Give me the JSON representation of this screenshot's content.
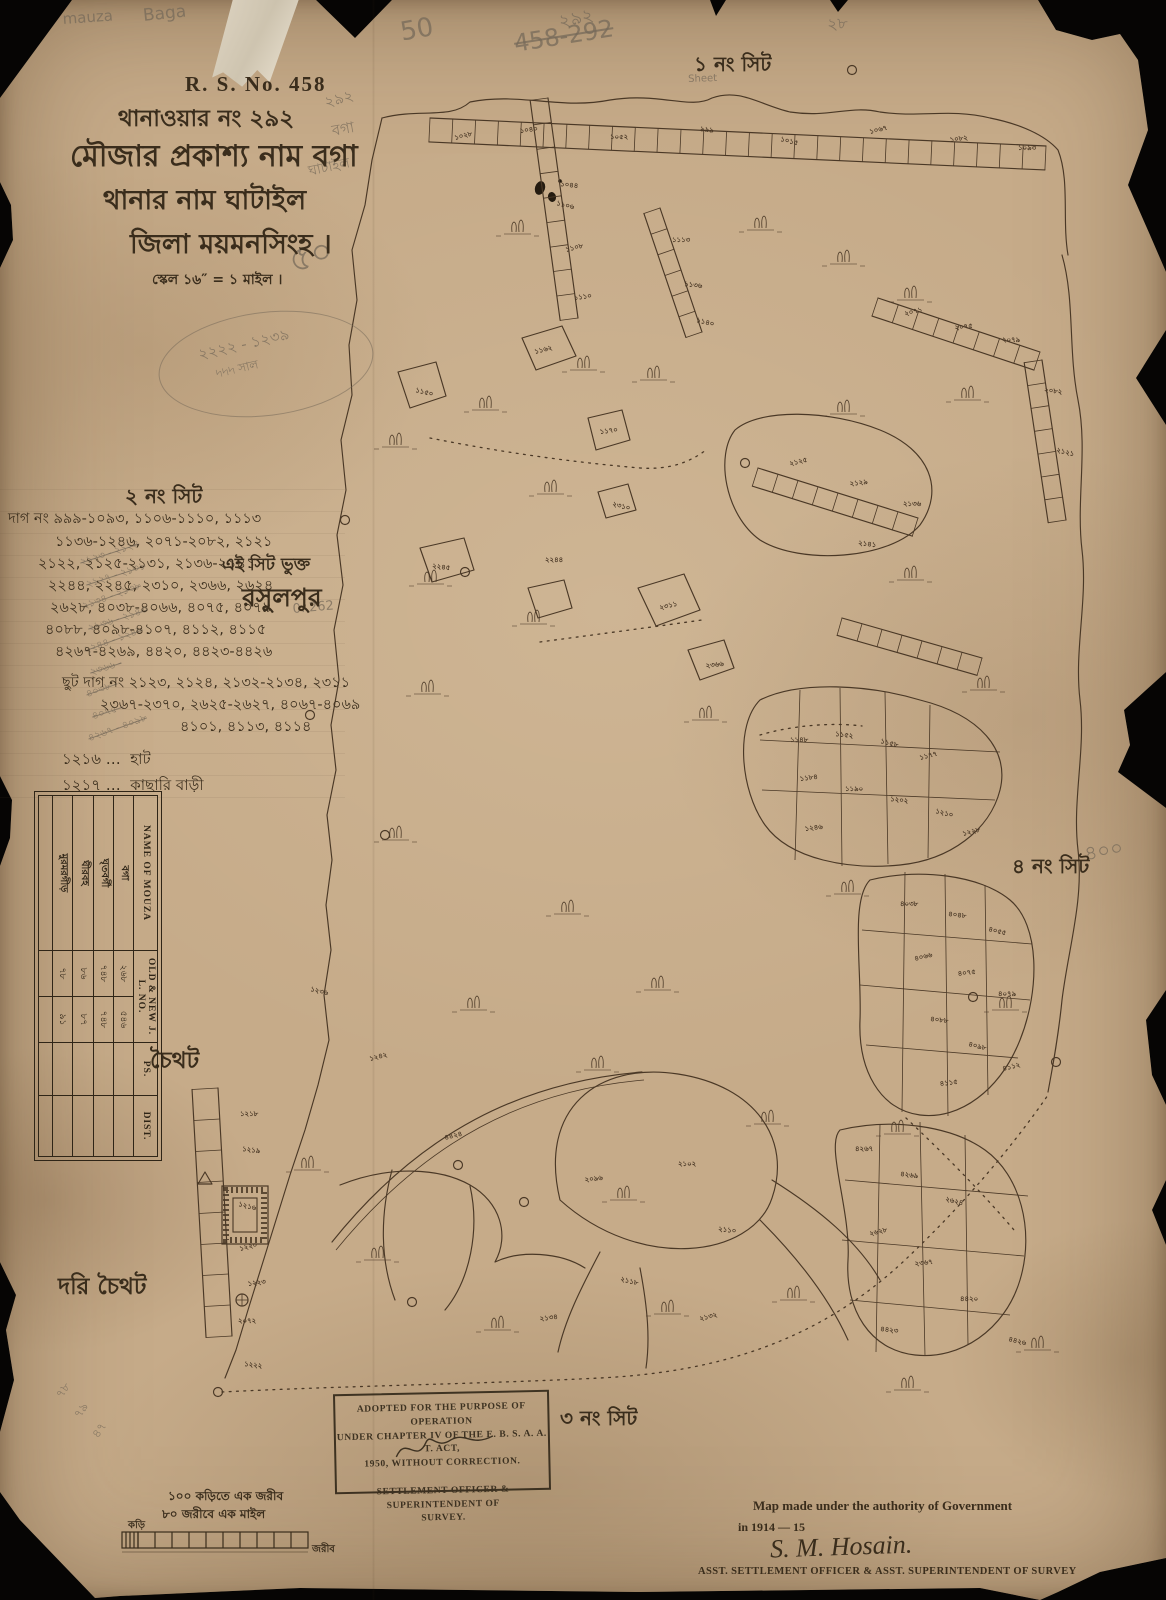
{
  "colors": {
    "paper": "#c6ab89",
    "ink": "#3a2d1c",
    "map_ink": "#4a3826",
    "pencil": "#766a5a",
    "backing": "#060504",
    "tape": "#d8cfbd"
  },
  "header": {
    "rs_no": "R. S. No. 458",
    "line_thana_no": "থানাওয়ার নং ২৯২",
    "line_mouza": "মৌজার প্রকাশ্য নাম  বগা",
    "line_thana": "থানার নাম ঘাটাইল",
    "line_district": "জিলা ময়মনসিংহ ।",
    "line_scale": "স্কেল ১৬″ = ১ মাইল ।"
  },
  "sheets": {
    "s1": "১ নং সিট",
    "s2": "২ নং সিট",
    "s3": "৩ নং সিট",
    "s4": "৪ নং সিট"
  },
  "dag": {
    "lines": [
      "দাগ নং ৯৯৯-১০৯৩, ১১০৬-১১১০, ১১১৩",
      "১১৩৬-১২৪৬, ২০৭১-২০৮২, ২১২১",
      "২১২২, ২১২৫-২১৩১, ২১৩৬-২১৪১",
      "২২৪৪, ২২৪৫, ২৩১০, ২৩৬৬, ২৬২৪",
      "২৬২৮, ৪০৩৮-৪০৬৬, ৪০৭৫, ৪০৭৯",
      "৪০৮৮, ৪০৯৮-৪১০৭, ৪১১২, ৪১১৫",
      "৪২৬৭-৪২৬৯, ৪৪২০, ৪৪২৩-৪৪২৬"
    ],
    "side_note": "এই সিট ভুক্ত",
    "village": "রসুলপুর",
    "chhut": [
      "ছুট দাগ নং ২১২৩, ২১২৪, ২১৩২-২১৩৪, ২৩১১",
      "২৩৬৭-২৩৭০, ২৬২৫-২৬২৭, ৪০৬৭-৪০৬৯",
      "৪১০১, ৪১১৩, ৪১১৪"
    ],
    "legend": [
      {
        "no": "১২১৬ …",
        "label": "হাট"
      },
      {
        "no": "১২১৭ …",
        "label": "কাছারি বাড়ী"
      }
    ]
  },
  "places": {
    "choithot": "চৈথট",
    "dori_choithot": "দরি চৈথট"
  },
  "table": {
    "h_name": "NAME OF MOUZA",
    "h_jl": "OLD & NEW J. L. NO.",
    "h_ps": "PS.",
    "h_dist": "DIST.",
    "rows": [
      {
        "name": "বগা",
        "old": "২৬৮",
        "new": "৫৪৬",
        "ps": "",
        "dist": ""
      },
      {
        "name": "ঘৃতবর্গী",
        "old": "৭৪৮",
        "new": "৭৪৮",
        "ps": "",
        "dist": ""
      },
      {
        "name": "ঘীরবহ",
        "old": "৮৬",
        "new": "৮৭",
        "ps": "",
        "dist": ""
      },
      {
        "name": "মুরমরগীড়",
        "old": "৭৮",
        "new": "৯১",
        "ps": "",
        "dist": ""
      }
    ]
  },
  "stamp": {
    "l1": "ADOPTED FOR THE PURPOSE OF OPERATION",
    "l2": "UNDER CHAPTER IV OF THE E. B. S. A. A. T. ACT,",
    "l3": "1950, WITHOUT CORRECTION.",
    "l4": "SETTLEMENT OFFICER & SUPERINTENDENT OF",
    "l5": "SURVEY."
  },
  "attribution": {
    "l1": "Map made under the authority of Government",
    "l2": "in 1914 — 15",
    "sig": "S. M. Hosain.",
    "l3": "ASST. SETTLEMENT OFFICER & ASST. SUPERINTENDENT OF SURVEY"
  },
  "scalebar": {
    "l1": "১০০ কড়িতে এক জরীব",
    "l2": "৮০ জরীবে এক মাইল",
    "left": "কড়ি",
    "right": "জরীব"
  },
  "pencil": {
    "scribbles": [
      {
        "x": 62,
        "y": 10,
        "t": "mauza",
        "r": -4,
        "s": 15
      },
      {
        "x": 142,
        "y": 6,
        "t": "Baga",
        "r": -6,
        "s": 17
      },
      {
        "x": 556,
        "y": 8,
        "t": "২৯২",
        "r": -12,
        "s": 18
      },
      {
        "x": 512,
        "y": 30,
        "t": "458-292",
        "r": -9,
        "s": 24,
        "strike": true
      },
      {
        "x": 398,
        "y": 18,
        "t": "50",
        "r": -10,
        "s": 26
      },
      {
        "x": 826,
        "y": 12,
        "t": "২৮",
        "r": -5,
        "s": 16
      },
      {
        "x": 322,
        "y": 92,
        "t": "২৯২",
        "r": -15,
        "s": 15
      },
      {
        "x": 330,
        "y": 120,
        "t": "বগা",
        "r": -10,
        "s": 15
      },
      {
        "x": 306,
        "y": 160,
        "t": "ঘাটাইল",
        "r": -12,
        "s": 14
      },
      {
        "x": 282,
        "y": 238,
        "t": "৫০",
        "r": -18,
        "s": 34
      },
      {
        "x": 196,
        "y": 344,
        "t": "২২২২ - ১২৩৯",
        "r": -13,
        "s": 15
      },
      {
        "x": 214,
        "y": 366,
        "t": "৸৸৸ সাল",
        "r": -13,
        "s": 12
      },
      {
        "x": 688,
        "y": 74,
        "t": "Sheet",
        "r": -2,
        "s": 10
      },
      {
        "x": 292,
        "y": 602,
        "t": "0. 262",
        "r": -5,
        "s": 13
      },
      {
        "x": 1082,
        "y": 840,
        "t": "৪০০",
        "r": -10,
        "s": 20
      },
      {
        "x": 78,
        "y": 556,
        "t": "২১২৩ - ২১২৪",
        "r": -18,
        "s": 10,
        "strike": true
      },
      {
        "x": 84,
        "y": 578,
        "t": "২১২৭ - ২১৩১",
        "r": -18,
        "s": 10,
        "strike": true
      },
      {
        "x": 80,
        "y": 600,
        "t": "২১৩৪ - ২১৩৮",
        "r": -20,
        "s": 10,
        "strike": true
      },
      {
        "x": 86,
        "y": 622,
        "t": "২১৩৬ - ২১৪৩",
        "r": -18,
        "s": 10,
        "strike": true
      },
      {
        "x": 82,
        "y": 644,
        "t": "২২৪৪ - ১২৪৮",
        "r": -20,
        "s": 10,
        "strike": true
      },
      {
        "x": 88,
        "y": 666,
        "t": "২৩৬৬ -",
        "r": -18,
        "s": 10,
        "strike": true
      },
      {
        "x": 84,
        "y": 688,
        "t": "৪০৩৮ -",
        "r": -20,
        "s": 10,
        "strike": true
      },
      {
        "x": 90,
        "y": 710,
        "t": "৪০৭৫ -",
        "r": -18,
        "s": 10,
        "strike": true
      },
      {
        "x": 86,
        "y": 732,
        "t": "৪২৬৭ - ৪০৯৮",
        "r": -20,
        "s": 10,
        "strike": true
      },
      {
        "x": 52,
        "y": 1392,
        "t": "৭৮",
        "r": -55,
        "s": 12
      },
      {
        "x": 70,
        "y": 1412,
        "t": "৭৯",
        "r": -55,
        "s": 12
      },
      {
        "x": 88,
        "y": 1432,
        "t": "৪৭",
        "r": -55,
        "s": 12
      }
    ]
  },
  "map": {
    "plot_labels": [
      {
        "x": 455,
        "y": 140,
        "t": "১০২৮"
      },
      {
        "x": 520,
        "y": 133,
        "t": "১০৪০"
      },
      {
        "x": 610,
        "y": 139,
        "t": "১০৫২"
      },
      {
        "x": 700,
        "y": 131,
        "t": "৯৯৯"
      },
      {
        "x": 780,
        "y": 141,
        "t": "১০১৫"
      },
      {
        "x": 870,
        "y": 134,
        "t": "১০৬৭"
      },
      {
        "x": 950,
        "y": 142,
        "t": "১০৮২"
      },
      {
        "x": 1018,
        "y": 150,
        "t": "১০৯৩"
      },
      {
        "x": 560,
        "y": 186,
        "t": "১০৪৪"
      },
      {
        "x": 556,
        "y": 205,
        "t": "১১০৬"
      },
      {
        "x": 566,
        "y": 252,
        "t": "১১০৮"
      },
      {
        "x": 574,
        "y": 300,
        "t": "১১১০"
      },
      {
        "x": 672,
        "y": 242,
        "t": "১১১৩"
      },
      {
        "x": 684,
        "y": 286,
        "t": "১১৩৬"
      },
      {
        "x": 696,
        "y": 322,
        "t": "১১৪০"
      },
      {
        "x": 905,
        "y": 316,
        "t": "২০৭১"
      },
      {
        "x": 955,
        "y": 330,
        "t": "২০৭৫"
      },
      {
        "x": 1002,
        "y": 342,
        "t": "২০৭৯"
      },
      {
        "x": 1044,
        "y": 392,
        "t": "২০৮২"
      },
      {
        "x": 1056,
        "y": 452,
        "t": "২১২১"
      },
      {
        "x": 790,
        "y": 466,
        "t": "২১২৫"
      },
      {
        "x": 850,
        "y": 486,
        "t": "২১২৯"
      },
      {
        "x": 903,
        "y": 506,
        "t": "২১৩৬"
      },
      {
        "x": 858,
        "y": 545,
        "t": "২১৪১"
      },
      {
        "x": 415,
        "y": 392,
        "t": "১১৫০"
      },
      {
        "x": 535,
        "y": 354,
        "t": "১১৬২"
      },
      {
        "x": 600,
        "y": 434,
        "t": "১১৭০"
      },
      {
        "x": 545,
        "y": 562,
        "t": "২২৪৪"
      },
      {
        "x": 432,
        "y": 568,
        "t": "২২৪৫"
      },
      {
        "x": 612,
        "y": 506,
        "t": "২৩১০"
      },
      {
        "x": 660,
        "y": 610,
        "t": "২৩১১"
      },
      {
        "x": 706,
        "y": 668,
        "t": "২৩৬৬"
      },
      {
        "x": 790,
        "y": 742,
        "t": "১১৪৮"
      },
      {
        "x": 835,
        "y": 736,
        "t": "১১৫২"
      },
      {
        "x": 880,
        "y": 743,
        "t": "১১৫৮"
      },
      {
        "x": 920,
        "y": 760,
        "t": "১১৭৭"
      },
      {
        "x": 800,
        "y": 781,
        "t": "১১৮৪"
      },
      {
        "x": 845,
        "y": 791,
        "t": "১১৯০"
      },
      {
        "x": 890,
        "y": 801,
        "t": "১২০২"
      },
      {
        "x": 935,
        "y": 813,
        "t": "১২১০"
      },
      {
        "x": 963,
        "y": 836,
        "t": "১২২৮"
      },
      {
        "x": 805,
        "y": 831,
        "t": "১২৪৬"
      },
      {
        "x": 900,
        "y": 906,
        "t": "৪০৩৮"
      },
      {
        "x": 948,
        "y": 916,
        "t": "৪০৪৮"
      },
      {
        "x": 988,
        "y": 931,
        "t": "৪০৫৫"
      },
      {
        "x": 915,
        "y": 961,
        "t": "৪০৬৬"
      },
      {
        "x": 958,
        "y": 976,
        "t": "৪০৭৫"
      },
      {
        "x": 998,
        "y": 996,
        "t": "৪০৭৯"
      },
      {
        "x": 930,
        "y": 1021,
        "t": "৪০৮৮"
      },
      {
        "x": 968,
        "y": 1046,
        "t": "৪০৯৮"
      },
      {
        "x": 1003,
        "y": 1071,
        "t": "৪১১২"
      },
      {
        "x": 940,
        "y": 1086,
        "t": "৪১১৫"
      },
      {
        "x": 855,
        "y": 1151,
        "t": "৪২৬৭"
      },
      {
        "x": 900,
        "y": 1176,
        "t": "৪২৬৯"
      },
      {
        "x": 945,
        "y": 1201,
        "t": "২৬২৪"
      },
      {
        "x": 870,
        "y": 1236,
        "t": "২৬২৮"
      },
      {
        "x": 915,
        "y": 1266,
        "t": "২৩৬৭"
      },
      {
        "x": 960,
        "y": 1301,
        "t": "৪৪২০"
      },
      {
        "x": 880,
        "y": 1331,
        "t": "৪৪২৩"
      },
      {
        "x": 1008,
        "y": 1341,
        "t": "৪৪২৬"
      },
      {
        "x": 445,
        "y": 1140,
        "t": "৪৪২৪",
        "s": 10
      },
      {
        "x": 585,
        "y": 1182,
        "t": "২০৯৬"
      },
      {
        "x": 678,
        "y": 1166,
        "t": "২১০২"
      },
      {
        "x": 718,
        "y": 1231,
        "t": "২১১০"
      },
      {
        "x": 620,
        "y": 1281,
        "t": "২১১৮"
      },
      {
        "x": 700,
        "y": 1321,
        "t": "২১৩২"
      },
      {
        "x": 540,
        "y": 1321,
        "t": "২১৩৪"
      },
      {
        "x": 240,
        "y": 1116,
        "t": "১২১৮"
      },
      {
        "x": 242,
        "y": 1151,
        "t": "১২১৯"
      },
      {
        "x": 238,
        "y": 1206,
        "t": "১২১৬"
      },
      {
        "x": 240,
        "y": 1251,
        "t": "১২২০"
      },
      {
        "x": 248,
        "y": 1286,
        "t": "১২২৩"
      },
      {
        "x": 238,
        "y": 1323,
        "t": "২০৭২"
      },
      {
        "x": 244,
        "y": 1366,
        "t": "১২২২"
      },
      {
        "x": 310,
        "y": 991,
        "t": "১২৩৬"
      },
      {
        "x": 370,
        "y": 1061,
        "t": "১২৪২"
      }
    ],
    "trees": [
      [
        390,
        445
      ],
      [
        480,
        408
      ],
      [
        578,
        368
      ],
      [
        648,
        378
      ],
      [
        545,
        492
      ],
      [
        425,
        582
      ],
      [
        528,
        622
      ],
      [
        422,
        692
      ],
      [
        562,
        912
      ],
      [
        390,
        838
      ],
      [
        755,
        228
      ],
      [
        838,
        262
      ],
      [
        905,
        298
      ],
      [
        962,
        398
      ],
      [
        838,
        412
      ],
      [
        905,
        578
      ],
      [
        978,
        688
      ],
      [
        842,
        892
      ],
      [
        652,
        988
      ],
      [
        592,
        1068
      ],
      [
        302,
        1168
      ],
      [
        372,
        1258
      ],
      [
        492,
        1328
      ],
      [
        662,
        1312
      ],
      [
        788,
        1298
      ],
      [
        902,
        1388
      ],
      [
        1000,
        1008
      ],
      [
        1032,
        1348
      ],
      [
        892,
        1132
      ],
      [
        762,
        1122
      ],
      [
        618,
        1198
      ],
      [
        512,
        232
      ],
      [
        700,
        718
      ],
      [
        468,
        1008
      ]
    ],
    "nodes": [
      [
        345,
        520
      ],
      [
        310,
        715
      ],
      [
        385,
        835
      ],
      [
        465,
        572
      ],
      [
        524,
        1202
      ],
      [
        218,
        1392
      ],
      [
        412,
        1302
      ],
      [
        852,
        70
      ],
      [
        973,
        997
      ],
      [
        1056,
        1062
      ],
      [
        745,
        463
      ],
      [
        458,
        1165
      ]
    ]
  }
}
